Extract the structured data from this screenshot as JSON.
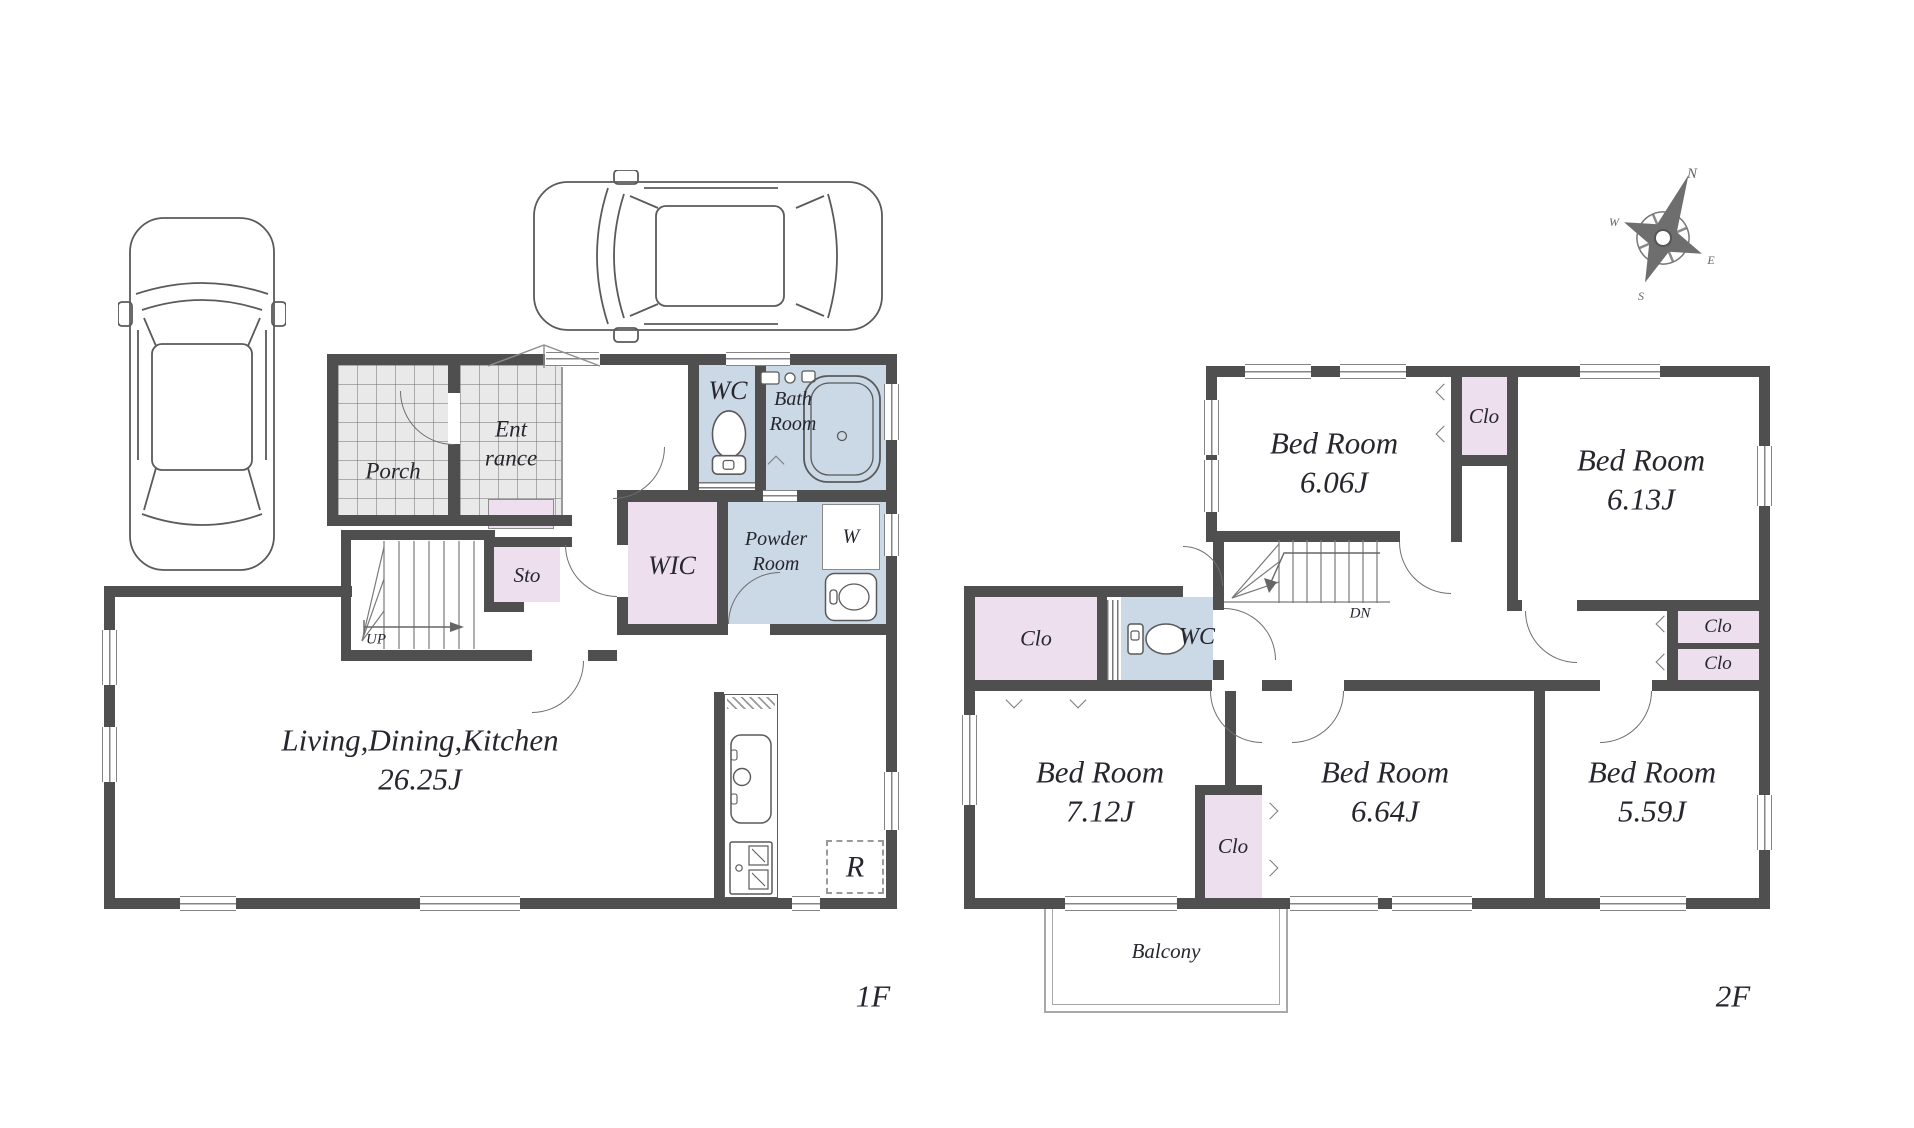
{
  "colors": {
    "wall": "#4f4f4f",
    "wet_room": "#cbd8e5",
    "closet": "#eddfee",
    "tile": "#e9e9e9",
    "line": "#6e6e6e",
    "ink": "#26262e"
  },
  "floor1": {
    "floor_label": "1F",
    "porch": "Porch",
    "entrance_line1": "Ent",
    "entrance_line2": "rance",
    "wc": "WC",
    "bath_line1": "Bath",
    "bath_line2": "Room",
    "storage": "Sto",
    "wic": "WIC",
    "powder_line1": "Powder",
    "powder_line2": "Room",
    "washer": "W",
    "stairs_up": "UP",
    "ldk_line1": "Living,Dining,Kitchen",
    "ldk_line2": "26.25J",
    "refrigerator": "R"
  },
  "floor2": {
    "floor_label": "2F",
    "bedroom1_name": "Bed Room",
    "bedroom1_size": "6.06J",
    "bedroom2_name": "Bed Room",
    "bedroom2_size": "6.13J",
    "bedroom3_name": "Bed Room",
    "bedroom3_size": "7.12J",
    "bedroom4_name": "Bed Room",
    "bedroom4_size": "6.64J",
    "bedroom5_name": "Bed Room",
    "bedroom5_size": "5.59J",
    "closet": "Clo",
    "wc": "WC",
    "stairs_down": "DN",
    "balcony": "Balcony"
  },
  "compass": {
    "north": "N",
    "east": "E",
    "south": "S",
    "west": "W"
  }
}
